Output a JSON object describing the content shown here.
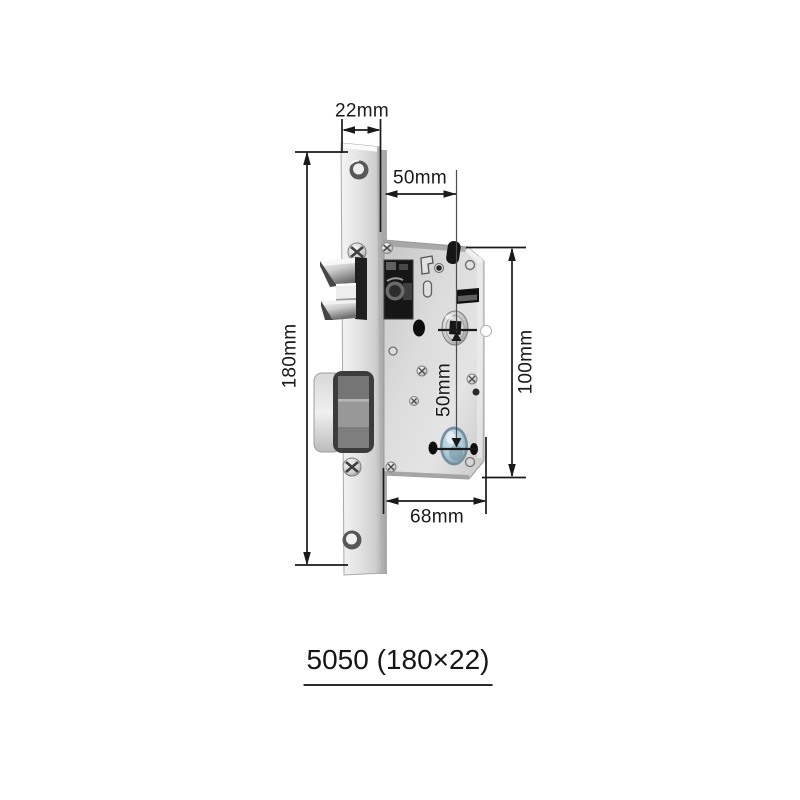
{
  "diagram": {
    "caption": "5050 (180×22)",
    "dimensions": {
      "faceplate_width": "22mm",
      "backset": "50mm",
      "faceplate_height": "180mm",
      "body_height": "100mm",
      "center_spacing": "50mm",
      "body_width": "68mm"
    },
    "colors": {
      "background": "#ffffff",
      "dimension_line": "#1a1a1a",
      "metal_light": "#f2f2f2",
      "metal_mid": "#d6d6d6",
      "metal_dark": "#8f8f8f",
      "cylinder_hole_blue": "#aecbd9",
      "hole_black": "#111111"
    }
  }
}
